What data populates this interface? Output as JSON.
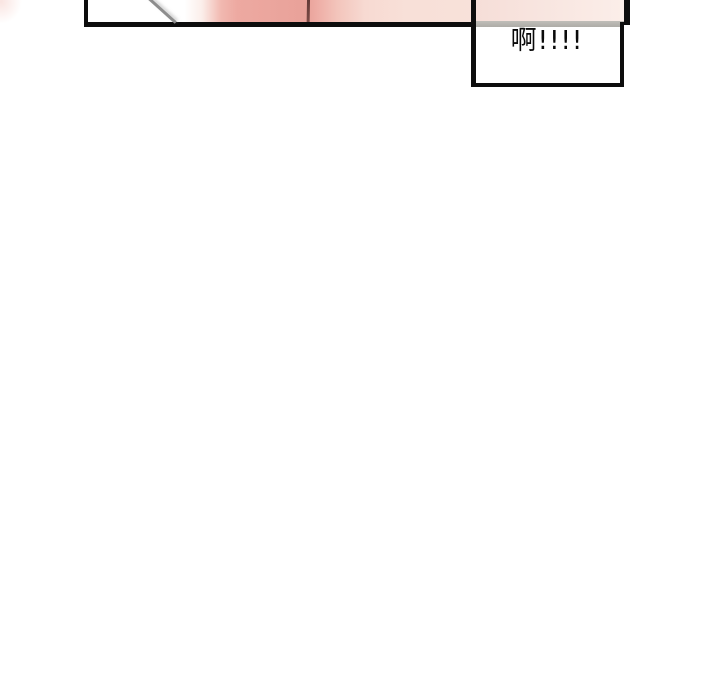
{
  "canvas": {
    "width": 720,
    "height": 700,
    "background": "#ffffff"
  },
  "panel": {
    "kind": "comic-panel-cropped-at-top",
    "border_color": "#0d0d0d",
    "art_colors": {
      "left_area": "#ffffff",
      "pink_main": "#e9a29a",
      "pink_fade": "#f8e4dd",
      "strand_line": "#8d8d8d",
      "dark_edge_line": "#5f3533"
    }
  },
  "speech_box": {
    "text": "啊!!!!",
    "text_color": "#0a0a0a",
    "border_color": "#0d0d0d",
    "fill": "#ffffff",
    "seen_through_tint": "#f8e6e0",
    "seen_through_band": "#b5b3ae"
  }
}
